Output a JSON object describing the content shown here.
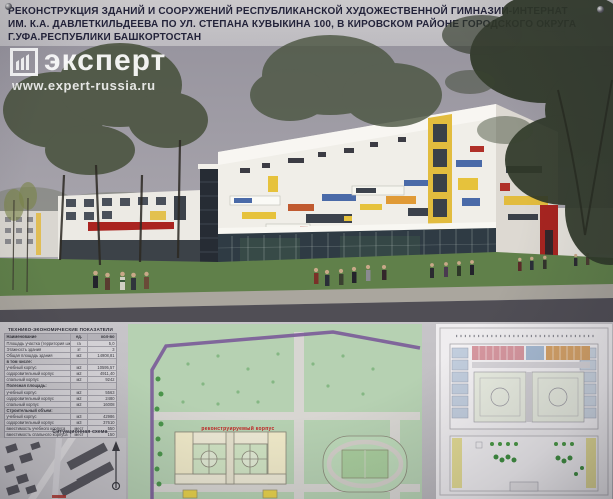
{
  "header": {
    "title_lines": [
      "РЕКОНСТРУКЦИЯ ЗДАНИЙ И СООРУЖЕНИЙ РЕСПУБЛИКАНСКОЙ ХУДОЖЕСТВЕННОЙ ГИМНАЗИИ-ИНТЕРНАТ",
      "ИМ. К.А. ДАВЛЕТКИЛЬДЕЕВА ПО УЛ. СТЕПАНА КУВЫКИНА 100, В КИРОВСКОМ РАЙОНЕ ГОРОДСКОГО ОКРУГА",
      "Г.УФА.РЕСПУБЛИКИ БАШКОРТОСТАН"
    ]
  },
  "watermark": {
    "brand": "эксперт",
    "url": "www.expert-russia.ru",
    "icon": "expert-columns-logo-icon"
  },
  "tep_table": {
    "title": "ТЕХНИКО-ЭКОНОМИЧЕСКИЕ ПОКАЗАТЕЛИ",
    "columns": [
      "Наименование",
      "ед.",
      "кол-во"
    ],
    "rows": [
      {
        "name": "Площадь участка (территория школы)",
        "unit": "га",
        "value": "5,0"
      },
      {
        "name": "Этажность здания",
        "unit": "эт",
        "value": "3"
      },
      {
        "name": "Общая площадь здания",
        "unit": "м2",
        "value": "14908,81"
      },
      {
        "name": "в том числе:",
        "unit": "",
        "value": ""
      },
      {
        "name": "учебный корпус",
        "unit": "м2",
        "value": "10595,57"
      },
      {
        "name": "оздоровительный корпус",
        "unit": "м2",
        "value": "4911,40"
      },
      {
        "name": "спальный корпус",
        "unit": "м2",
        "value": "9242"
      },
      {
        "name": "Полезная площадь:",
        "unit": "",
        "value": ""
      },
      {
        "name": "учебный корпус",
        "unit": "м2",
        "value": "5563"
      },
      {
        "name": "оздоровительный корпус",
        "unit": "м2",
        "value": "2480"
      },
      {
        "name": "спальный корпус",
        "unit": "м2",
        "value": "16008"
      },
      {
        "name": "Строительный объем:",
        "unit": "",
        "value": ""
      },
      {
        "name": "учебный корпус",
        "unit": "м3",
        "value": "42986"
      },
      {
        "name": "оздоровительный корпус",
        "unit": "м3",
        "value": "37610"
      },
      {
        "name": "вместимость учебного корпуса",
        "unit": "мест",
        "value": "550"
      },
      {
        "name": "вместимость спального корпуса",
        "unit": "мест",
        "value": "150"
      }
    ]
  },
  "site_scheme": {
    "label": "Ситуационная схема"
  },
  "master_plan": {
    "building_label": "реконструируемый корпус"
  },
  "colors": {
    "accent_red": "#a82420",
    "accent_yellow": "#e2bc3e",
    "accent_blue": "#4a6aa8",
    "plan_green": "#b6d1b2",
    "boundary_purple": "#7a5a98",
    "sky_grey": "#9b99a3"
  }
}
